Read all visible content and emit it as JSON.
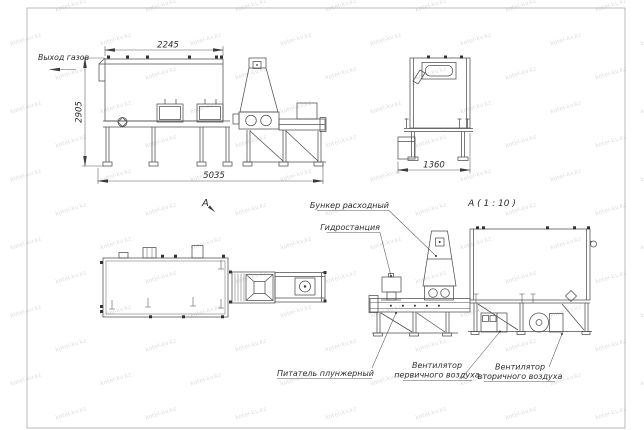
{
  "watermark": {
    "text": "kotel-kv.kz"
  },
  "side_view": {
    "gas_outlet": "Выход газов",
    "dim_body_length": "2245",
    "dim_height": "2905",
    "dim_total_length": "5035"
  },
  "end_view": {
    "dim_width": "1360"
  },
  "plan_view": {
    "view_mark": "А"
  },
  "detail_view": {
    "title": "А ( 1 : 10 )",
    "label_hopper": "Бункер расходный",
    "label_hydro": "Гидростанция",
    "label_feeder": "Питатель плунжерный",
    "label_primary_fan_line1": "Вентилятор",
    "label_primary_fan_line2": "первичного воздуха",
    "label_secondary_fan_line1": "Вентилятор",
    "label_secondary_fan_line2": "вторичного воздуха"
  }
}
